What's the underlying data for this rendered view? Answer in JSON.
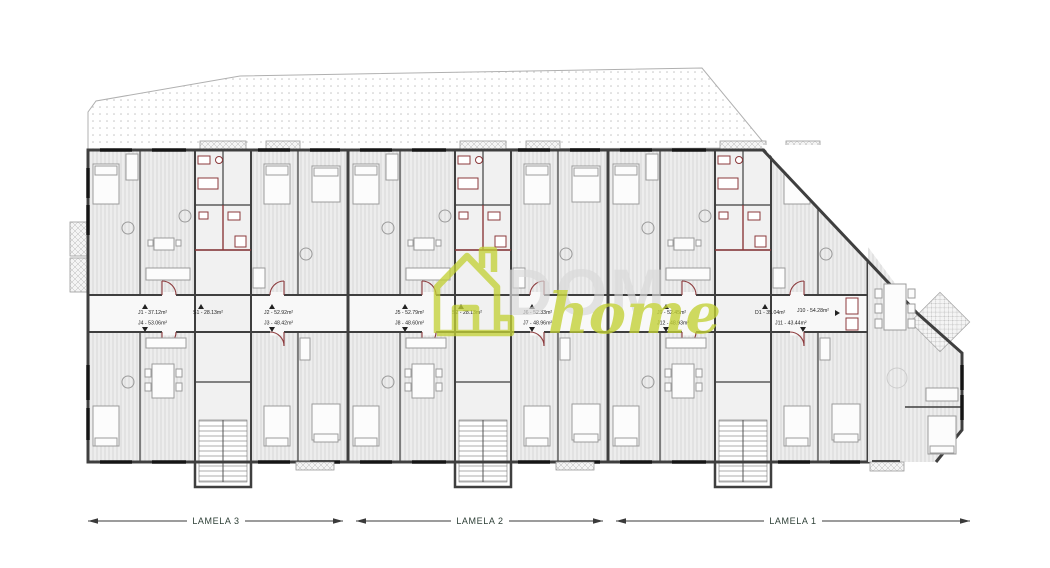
{
  "watermark": {
    "word_dom": "DOM",
    "word_home": "home",
    "icon": "house-icon",
    "green": "#c3d136",
    "gray": "#d9d9d9"
  },
  "sections": [
    {
      "label": "LAMELA 3",
      "apartments": {
        "left_top": "J1 - 37.12m²",
        "left_bottom": "J4 - 53.06m²",
        "center": "S1 - 28.13m²",
        "right_top": "J2 - 52.92m²",
        "right_bottom": "J3 - 48.42m²"
      }
    },
    {
      "label": "LAMELA 2",
      "apartments": {
        "left_top": "J5 - 52.79m²",
        "left_bottom": "J8 - 48.60m²",
        "center": "S2 - 28.13m²",
        "right_top": "J6 - 52.33m²",
        "right_bottom": "J7 - 48.96m²"
      }
    },
    {
      "label": "LAMELA 1",
      "apartments": {
        "left_top": "J9 - 52.45m²",
        "left_bottom": "J12 - 48.93m²",
        "center": "D1 - 35.04m²",
        "right_top": "J10 - 54.28m²",
        "right_bottom": "J11 - 43.44m²"
      }
    }
  ],
  "colors": {
    "wall": "#3f3f3f",
    "accent_red": "#8c3a3c",
    "floor_stripe": "#d2d2d2",
    "terrace_dot": "#c4c4c4",
    "dimension": "#3a3a3a"
  }
}
